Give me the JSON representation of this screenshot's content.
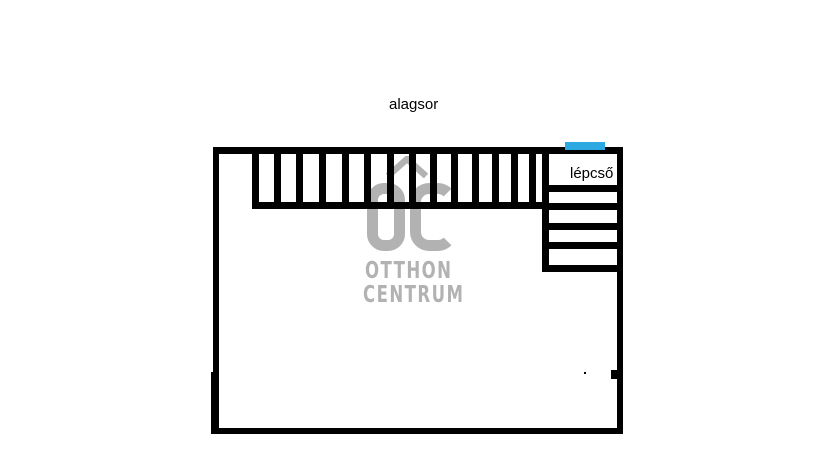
{
  "page": {
    "width": 813,
    "height": 460,
    "background": "#ffffff"
  },
  "floorplan": {
    "title": "alagsor",
    "stairs_label": "lépcső",
    "wall_color": "#000000",
    "accent_color": "#2BA9E0",
    "watermark": {
      "logo": "oc",
      "roof_icon": "house-roof",
      "line1": "OTTHON",
      "line2": "CENTRUM",
      "color": "#b2b2b2"
    },
    "geometry": {
      "outer_walls": [
        {
          "name": "wall-top",
          "x": 213,
          "y": 147,
          "w": 410,
          "h": 7
        },
        {
          "name": "wall-left",
          "x": 213,
          "y": 147,
          "w": 6,
          "h": 287
        },
        {
          "name": "wall-right",
          "x": 617,
          "y": 147,
          "w": 6,
          "h": 287
        },
        {
          "name": "wall-bottom",
          "x": 213,
          "y": 428,
          "w": 410,
          "h": 6
        }
      ],
      "stair_run": {
        "hatch_lines_x": [
          252,
          274,
          296,
          319,
          342,
          364,
          387,
          409,
          430,
          451,
          472,
          492,
          511,
          529
        ],
        "hatch_top": 151,
        "hatch_height": 57,
        "hatch_width": 7,
        "base_line": {
          "x": 252,
          "y": 202,
          "w": 297,
          "h": 7
        }
      },
      "stair_compartment": {
        "wall": {
          "x": 542,
          "y": 147,
          "w": 7,
          "h": 125
        },
        "tread_x": 542,
        "tread_w": 81,
        "tread_h": 7,
        "tread_ys": [
          185,
          203,
          223,
          242,
          265
        ]
      },
      "entry_marker": {
        "x": 565,
        "y": 142,
        "w": 40,
        "h": 8
      },
      "specks": [
        {
          "x": 611,
          "y": 370,
          "w": 6,
          "h": 9
        },
        {
          "x": 584,
          "y": 372,
          "w": 2,
          "h": 2
        },
        {
          "x": 211,
          "y": 372,
          "w": 3,
          "h": 62
        }
      ]
    }
  }
}
